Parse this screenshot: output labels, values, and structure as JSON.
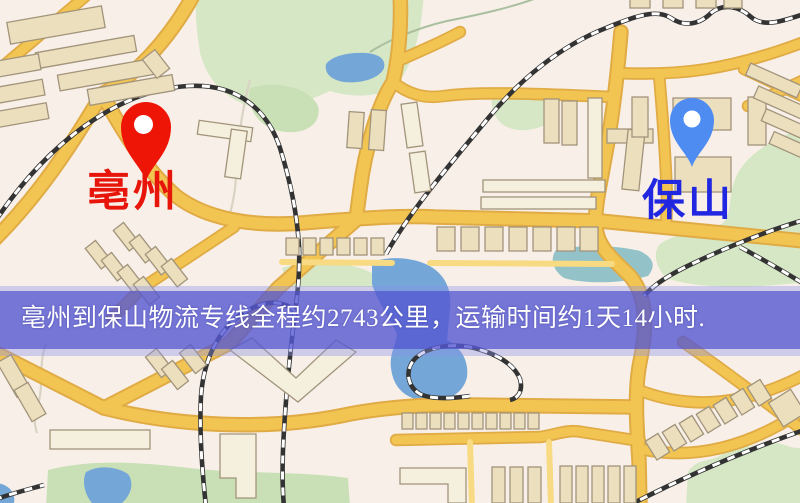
{
  "map": {
    "type": "logistics-route-map",
    "origin": {
      "label": "亳州",
      "marker": "red-pin"
    },
    "destination": {
      "label": "保山",
      "marker": "blue-pin"
    },
    "banner": {
      "text": "亳州到保山物流专线全程约2743公里，运输时间约1天14小时.",
      "distance_km": "2743",
      "transit_time": "1天14小时"
    },
    "colors": {
      "background": "#f8f0e8",
      "road": "#f2c452",
      "road_casing": "#e0ab45",
      "road_minor": "#f7da82",
      "building": "#ebdfbe",
      "building_light": "#f5efdd",
      "building_outline": "#a2947b",
      "green": "#d6e7c5",
      "green_dark": "#c9dfb6",
      "water": "#74a7d8",
      "water_teal": "#93c3c9",
      "rail": "#333333",
      "stream": "#a9bfa0",
      "path_line": "#d9d3c4",
      "banner": "#5557d2",
      "banner_edge": "#8a90e8",
      "banner_text": "#ffffff",
      "origin_label": "#e8150a",
      "destination_label": "#2127e0",
      "origin_marker": "#ee1507",
      "destination_marker": "#4f8cf2"
    }
  }
}
